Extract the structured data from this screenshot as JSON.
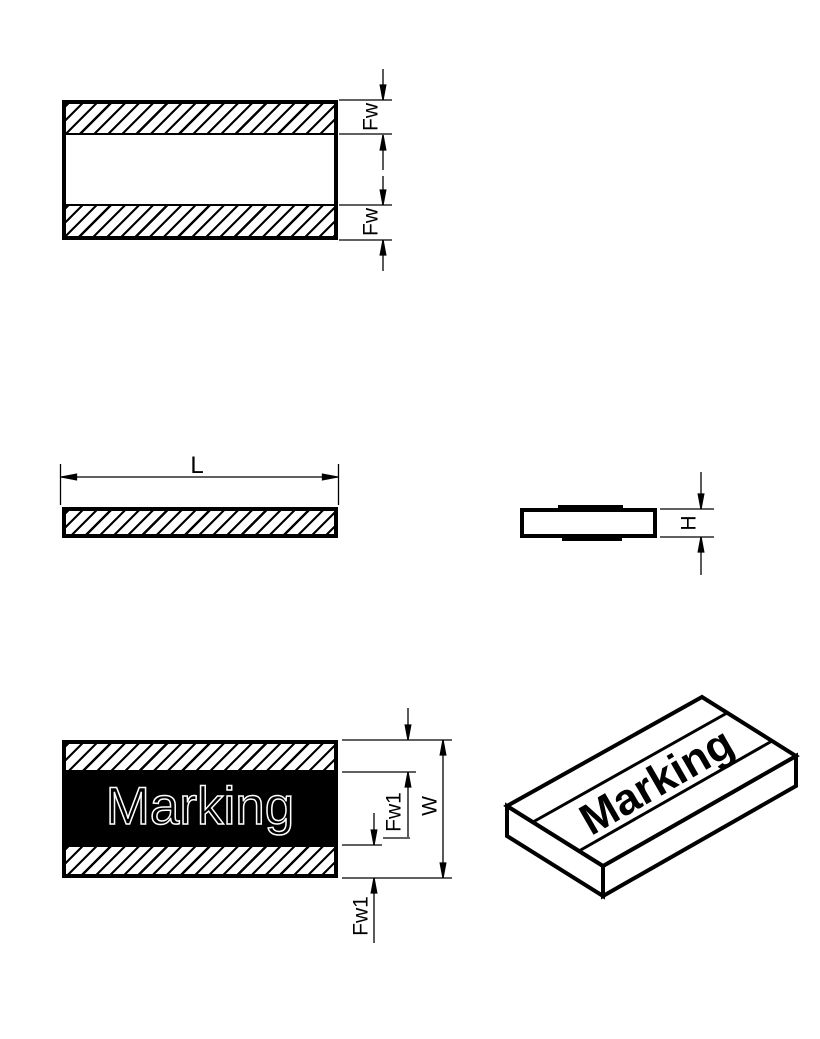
{
  "page": {
    "background": "#ffffff",
    "line_color": "#000000",
    "marking_band_color": "#000000",
    "marking_outline_color": "#ffffff"
  },
  "views": {
    "top": {
      "dims": {
        "band_top": "Fw",
        "band_bottom": "Fw"
      }
    },
    "length": {
      "dims": {
        "length": "L"
      }
    },
    "side": {
      "dims": {
        "height": "H"
      }
    },
    "front": {
      "marking": "Marking",
      "dims": {
        "band_top": "Fw1",
        "band_bottom": "Fw1",
        "width": "W"
      }
    },
    "iso": {
      "marking": "Marking"
    }
  }
}
